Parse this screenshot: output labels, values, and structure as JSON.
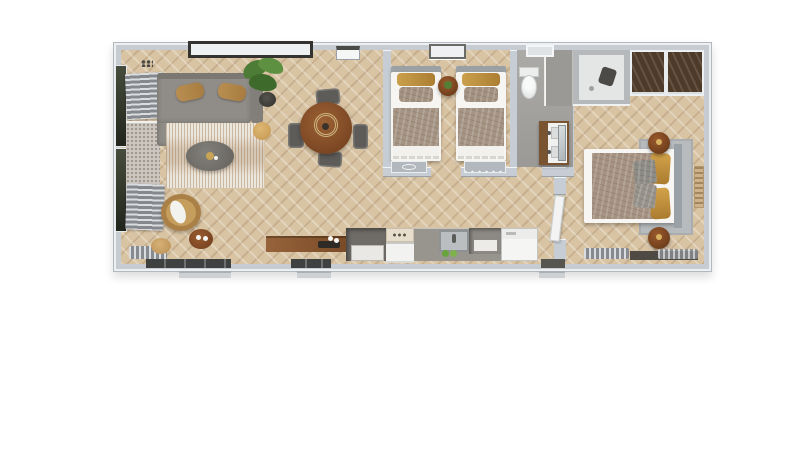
{
  "scene": {
    "title": "3D top-down floor plan render of a single-storey mobile home",
    "background": "#ffffff",
    "floorplan_style": "photoreal 3D dollhouse view, herringbone wood floors, light grey walls"
  },
  "palette": {
    "wall": "#c6cdd4",
    "wall_highlight": "#f2f5f7",
    "floor_wood": "#d8c3a3",
    "floor_bathroom": "#a5a3a0",
    "sofa_grey": "#908c87",
    "rug_cream": "#ece7dd",
    "wood_brown": "#8a5a33",
    "duvet_taupe": "#a59282",
    "pillow_gold": "#c2913c",
    "appliance_white": "#f4f4f2",
    "glass_dark": "#35342f",
    "plant_green": "#4d7c36",
    "rattan_tan": "#c59e5e",
    "dark_wardrobe": "#4e3a28"
  },
  "rooms": {
    "living": {
      "label": "Living room",
      "furniture": [
        "corner sofa with chaise",
        "two woven pillows",
        "cream shag rug",
        "oval grey coffee table",
        "rattan armchair with white cushion",
        "round side table",
        "small tan side table",
        "tan pouf",
        "potted plant",
        "two slatted benches",
        "speckled window seats",
        "glazed left wall"
      ]
    },
    "dining": {
      "label": "Dining area",
      "furniture": [
        "round wooden table with placemat",
        "four grey chairs"
      ]
    },
    "kitchen": {
      "label": "Kitchen",
      "furniture": [
        "long wooden sideboard with tray and vases",
        "tall dark cabinet",
        "cooktop",
        "oven",
        "inset sink with faucet",
        "herb pots",
        "open shelf unit",
        "fridge"
      ]
    },
    "twin_bedroom": {
      "label": "Twin bedroom",
      "furniture": [
        "single bed with gold and taupe pillows",
        "single bed with gold and taupe pillows",
        "round wooden nightstand with plant",
        "built-in console with oval handle",
        "built-in console with knobs",
        "window"
      ]
    },
    "bathroom": {
      "label": "Bathroom",
      "furniture": [
        "toilet",
        "tiled wall panels",
        "walk-in shower with dark fixture",
        "wood double-sink vanity",
        "leaning mirror"
      ]
    },
    "hallway": {
      "label": "Hallway",
      "furniture": [
        "white door ajar to master bedroom"
      ]
    },
    "master_bedroom": {
      "label": "Master bedroom",
      "furniture": [
        "double bed with taupe duvet",
        "gold pillows",
        "grey cushions",
        "grey area rug",
        "two round dark-wood nightstands",
        "dark wood wardrobe with white dividers",
        "shower nook",
        "vertical wall art",
        "slatted radiator",
        "dark bench"
      ]
    }
  },
  "exterior": {
    "label": "Outside",
    "features": [
      "three entry steps along bottom wall",
      "window frames protruding from top wall"
    ]
  }
}
